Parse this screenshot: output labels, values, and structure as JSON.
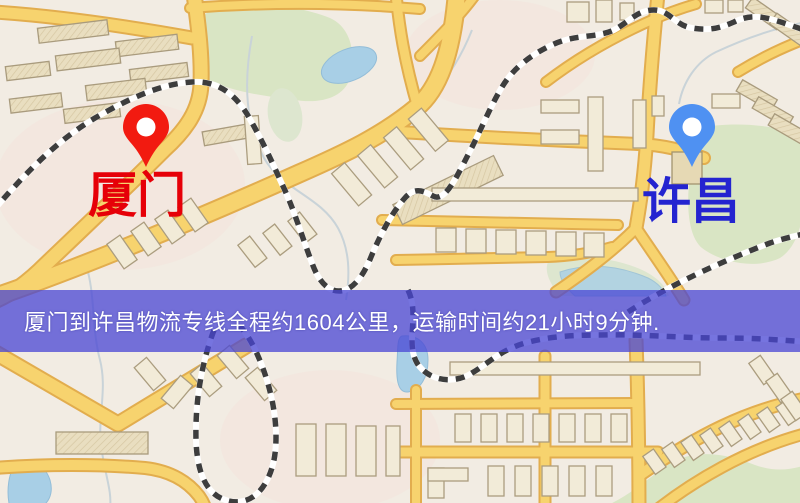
{
  "map": {
    "markers": [
      {
        "id": "origin",
        "label": "厦门",
        "label_color": "#e60008",
        "pin_color": "#f21a10",
        "pin": "red-pin"
      },
      {
        "id": "destination",
        "label": "许昌",
        "label_color": "#2424d0",
        "pin_color": "#4f91f2",
        "pin": "blue-pin"
      }
    ],
    "caption": {
      "text": "厦门到许昌物流专线全程约1604公里，运输时间约21小时9分钟.",
      "distance_km": "1604",
      "duration": "21小时9分钟",
      "background": "rgba(72,70,212,0.75)",
      "text_color": "#ffffff"
    },
    "palette": {
      "background": "#f2ece3",
      "road": "#f7d36e",
      "road_casing": "#e2ad4e",
      "building": "#eadfc0",
      "green_area": "#d9e5c4",
      "water": "#a8cfe6",
      "railway_dash": "#3d3d3d"
    }
  }
}
